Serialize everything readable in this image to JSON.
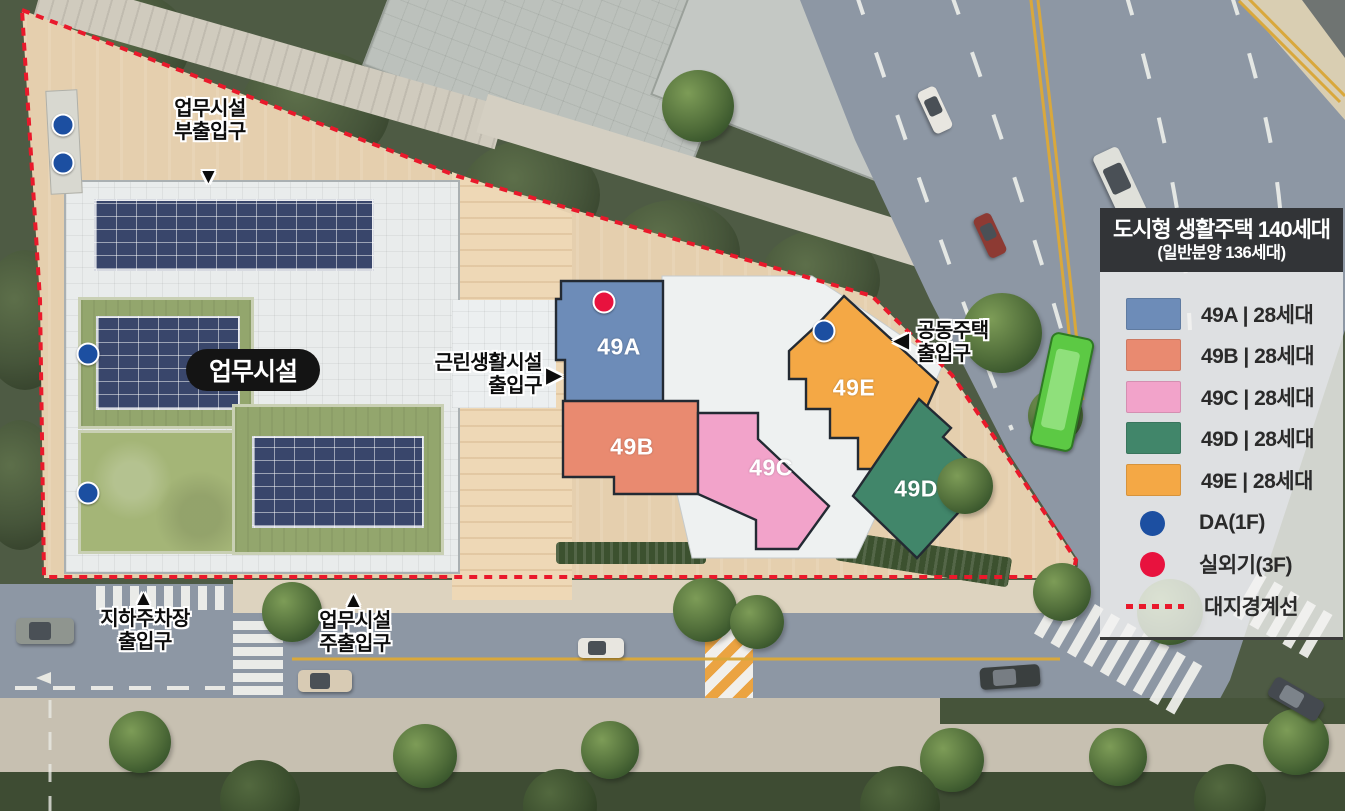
{
  "legend": {
    "title": "도시형 생활주택 140세대",
    "subtitle": "(일반분양 136세대)",
    "items": [
      {
        "key": "49A",
        "label": "49A | 28세대",
        "color": "#6d8cb8"
      },
      {
        "key": "49B",
        "label": "49B | 28세대",
        "color": "#e98a70"
      },
      {
        "key": "49C",
        "label": "49C | 28세대",
        "color": "#f2a3ca"
      },
      {
        "key": "49D",
        "label": "49D | 28세대",
        "color": "#41866a"
      },
      {
        "key": "49E",
        "label": "49E | 28세대",
        "color": "#f4a845"
      }
    ],
    "markers": [
      {
        "label": "DA(1F)",
        "color": "#1c4fa1"
      },
      {
        "label": "실외기(3F)",
        "color": "#e8123e"
      },
      {
        "label": "대지경계선",
        "color": "#e9192b"
      }
    ]
  },
  "map": {
    "office_label": "업무시설",
    "units": {
      "a": "49A",
      "b": "49B",
      "c": "49C",
      "d": "49D",
      "e": "49E"
    },
    "entrances": {
      "office_sub": {
        "line1": "업무시설",
        "line2": "부출입구",
        "arrow": "▼"
      },
      "retail": {
        "line1": "근린생활시설",
        "line2": "출입구",
        "arrow": "▶"
      },
      "housing": {
        "line1": "공동주택",
        "line2": "출입구",
        "arrow": "◀"
      },
      "parking": {
        "line1": "지하주차장",
        "line2": "출입구",
        "arrow": "▲"
      },
      "office_main": {
        "line1": "업무시설",
        "line2": "주출입구",
        "arrow": "▲"
      }
    }
  },
  "colors": {
    "boundary_red": "#e9192b",
    "da_dot_blue": "#1c4fa1",
    "outdoor_unit_red": "#e8123e"
  }
}
